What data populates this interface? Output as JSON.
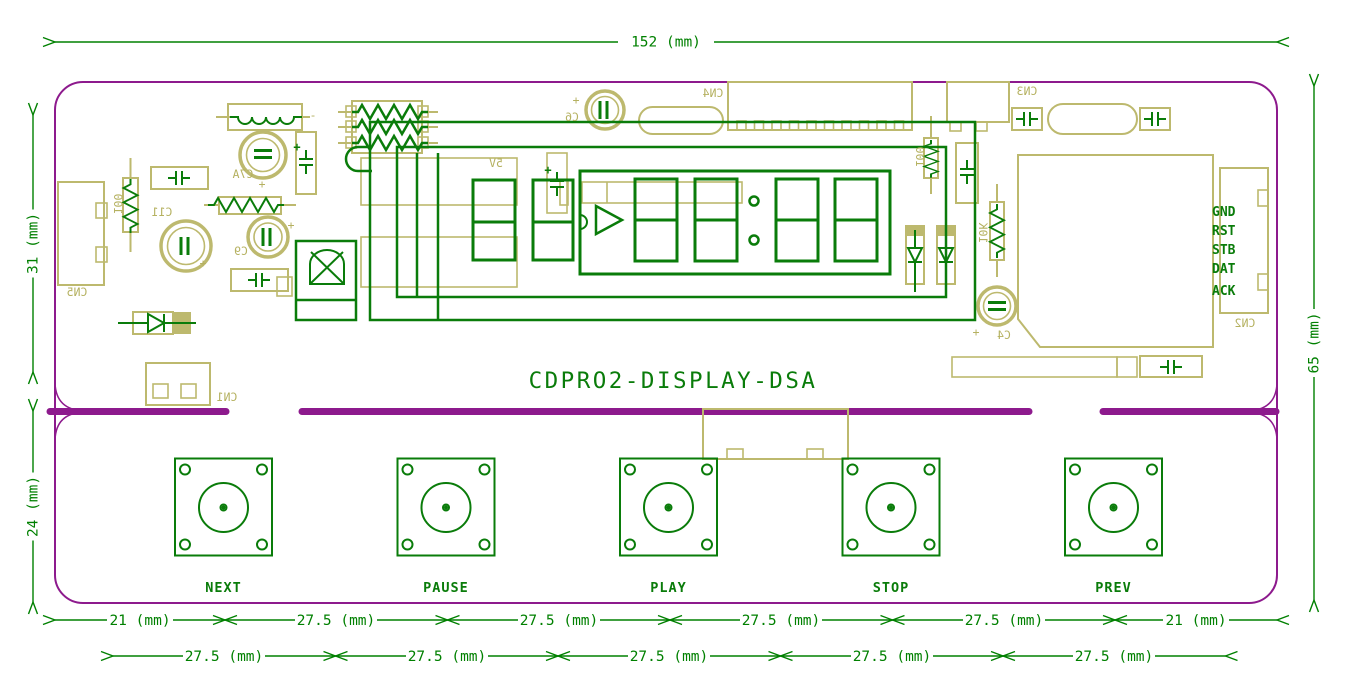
{
  "board": {
    "title": "CDPRO2-DISPLAY-DSA"
  },
  "dimensions": {
    "top": "152 (mm)",
    "left_upper": "31 (mm)",
    "left_lower": "24 (mm)",
    "right": "65 (mm)",
    "bottom_row1": [
      "21 (mm)",
      "27.5 (mm)",
      "27.5 (mm)",
      "27.5 (mm)",
      "27.5 (mm)",
      "21 (mm)"
    ],
    "bottom_row2": [
      "27.5 (mm)",
      "27.5 (mm)",
      "27.5 (mm)",
      "27.5 (mm)",
      "27.5 (mm)"
    ]
  },
  "buttons": [
    "NEXT",
    "PAUSE",
    "PLAY",
    "STOP",
    "PREV"
  ],
  "signals": [
    "GND",
    "RST",
    "STB",
    "DAT",
    "ACK"
  ],
  "refs": {
    "cn1": "CN1",
    "cn2": "CN2",
    "cn3": "CN3",
    "cn4": "CN4",
    "cn5": "CN5",
    "c4": "C4",
    "c6": "C6",
    "c7a": "C7A",
    "c9": "C9",
    "c11": "C11",
    "r100_left": "100",
    "r100_right": "100",
    "r10k": "10K",
    "rail_5v": "5V",
    "plus": "+",
    "minus": "-"
  },
  "colors": {
    "top_silk": "#0a7c0a",
    "bottom_silk": "#bdb96e",
    "board_outline": "#8d1a8d",
    "dimension": "#008000",
    "background": "#ffffff"
  }
}
